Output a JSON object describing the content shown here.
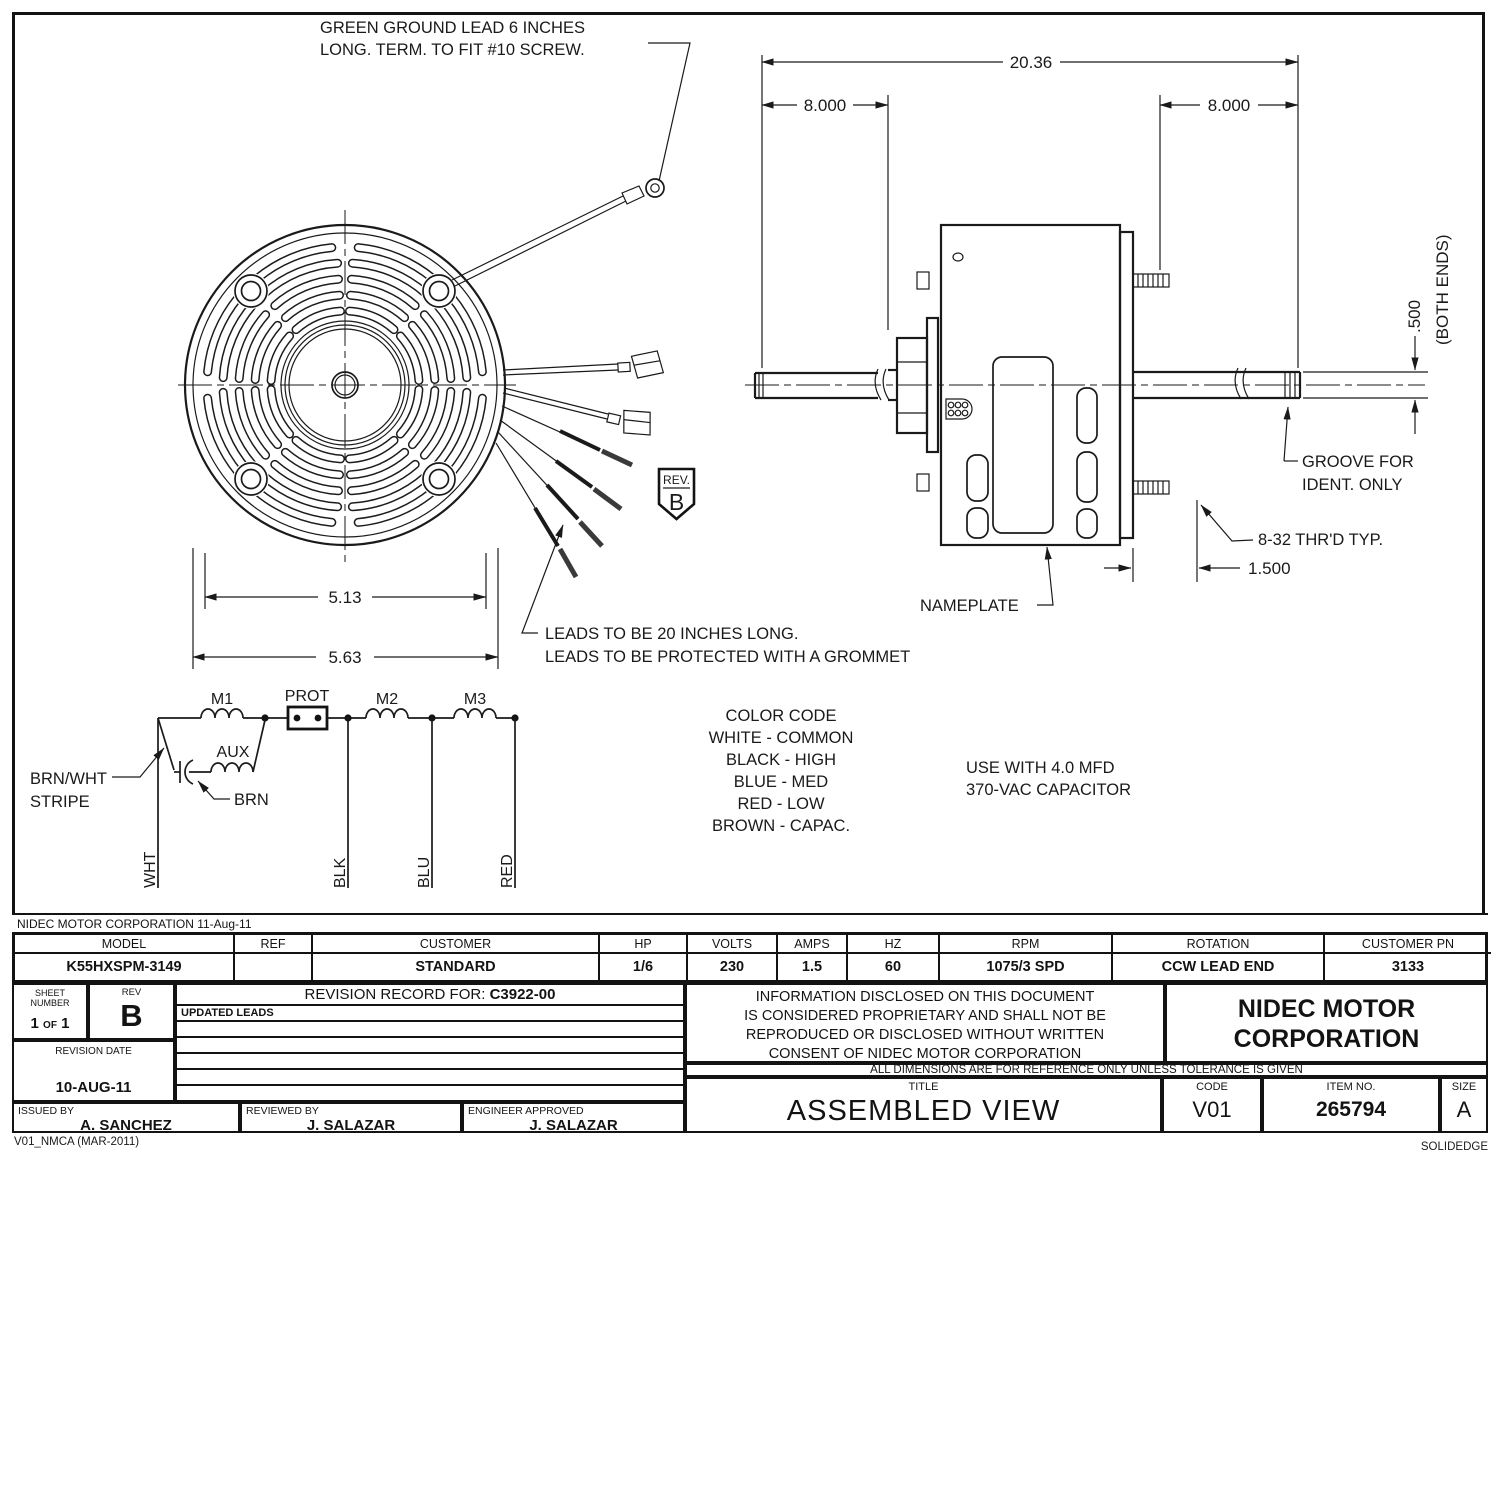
{
  "sheet": {
    "corp_line": "NIDEC MOTOR CORPORATION 11-Aug-11",
    "footer_left": "V01_NMCA (MAR-2011)",
    "footer_right": "SOLIDEDGE"
  },
  "drawing": {
    "ground_note_1": "GREEN GROUND LEAD 6 INCHES",
    "ground_note_2": "LONG. TERM. TO FIT #10 SCREW.",
    "leads_note_1": "LEADS TO BE 20 INCHES LONG.",
    "leads_note_2": "LEADS TO BE PROTECTED WITH A GROMMET",
    "nameplate_label": "NAMEPLATE",
    "groove_label_1": "GROOVE FOR",
    "groove_label_2": "IDENT. ONLY",
    "thread_label": "8-32 THR'D TYP.",
    "rev_flag_label": "REV.",
    "rev_flag_value": "B",
    "capacitor_note_1": "USE WITH 4.0 MFD",
    "capacitor_note_2": "370-VAC CAPACITOR",
    "dims": {
      "overall_length": "20.36",
      "shaft_ext_left": "8.000",
      "shaft_ext_right": "8.000",
      "shaft_dia": ".500",
      "shaft_dia_note": "(BOTH ENDS)",
      "stud_length": "1.500",
      "bolt_circle": "5.13",
      "body_dia": "5.63"
    },
    "schematic": {
      "m1": "M1",
      "prot": "PROT",
      "m2": "M2",
      "m3": "M3",
      "aux": "AUX",
      "lead_brnwht_1": "BRN/WHT",
      "lead_brnwht_2": "STRIPE",
      "lead_brn": "BRN",
      "lead_wht": "WHT",
      "lead_blk": "BLK",
      "lead_blu": "BLU",
      "lead_red": "RED"
    },
    "color_code": {
      "title": "COLOR CODE",
      "entries": [
        "WHITE - COMMON",
        "BLACK - HIGH",
        "BLUE - MED",
        "RED - LOW",
        "BROWN - CAPAC."
      ]
    }
  },
  "title_block": {
    "spec": [
      {
        "label": "MODEL",
        "value": "K55HXSPM-3149"
      },
      {
        "label": "REF",
        "value": ""
      },
      {
        "label": "CUSTOMER",
        "value": "STANDARD"
      },
      {
        "label": "HP",
        "value": "1/6"
      },
      {
        "label": "VOLTS",
        "value": "230"
      },
      {
        "label": "AMPS",
        "value": "1.5"
      },
      {
        "label": "HZ",
        "value": "60"
      },
      {
        "label": "RPM",
        "value": "1075/3 SPD"
      },
      {
        "label": "ROTATION",
        "value": "CCW LEAD END"
      },
      {
        "label": "CUSTOMER PN",
        "value": "3133"
      }
    ],
    "sheet_label_1": "SHEET",
    "sheet_label_2": "NUMBER",
    "sheet_n1": "1",
    "sheet_of": "OF",
    "sheet_n2": "1",
    "rev_label": "REV",
    "rev_value": "B",
    "revision_record_label": "REVISION RECORD FOR:",
    "revision_record_number": "C3922-00",
    "revision_rows": [
      "UPDATED LEADS",
      "",
      "",
      "",
      "",
      ""
    ],
    "revision_date_label": "REVISION DATE",
    "revision_date": "10-AUG-11",
    "issued_label": "ISSUED BY",
    "issued_by": "A. SANCHEZ",
    "reviewed_label": "REVIEWED BY",
    "reviewed_by": "J. SALAZAR",
    "approved_label": "ENGINEER APPROVED",
    "approved_by": "J. SALAZAR",
    "proprietary": [
      "INFORMATION DISCLOSED ON THIS DOCUMENT",
      "IS CONSIDERED PROPRIETARY AND SHALL NOT BE",
      "REPRODUCED OR DISCLOSED WITHOUT WRITTEN",
      "CONSENT OF NIDEC MOTOR CORPORATION"
    ],
    "company_1": "NIDEC MOTOR",
    "company_2": "CORPORATION",
    "disclaimer": "ALL DIMENSIONS ARE FOR REFERENCE ONLY UNLESS TOLERANCE IS GIVEN",
    "title_label": "TITLE",
    "title": "ASSEMBLED VIEW",
    "code_label": "CODE",
    "code": "V01",
    "item_label": "ITEM NO.",
    "item": "265794",
    "size_label": "SIZE",
    "size": "A"
  }
}
